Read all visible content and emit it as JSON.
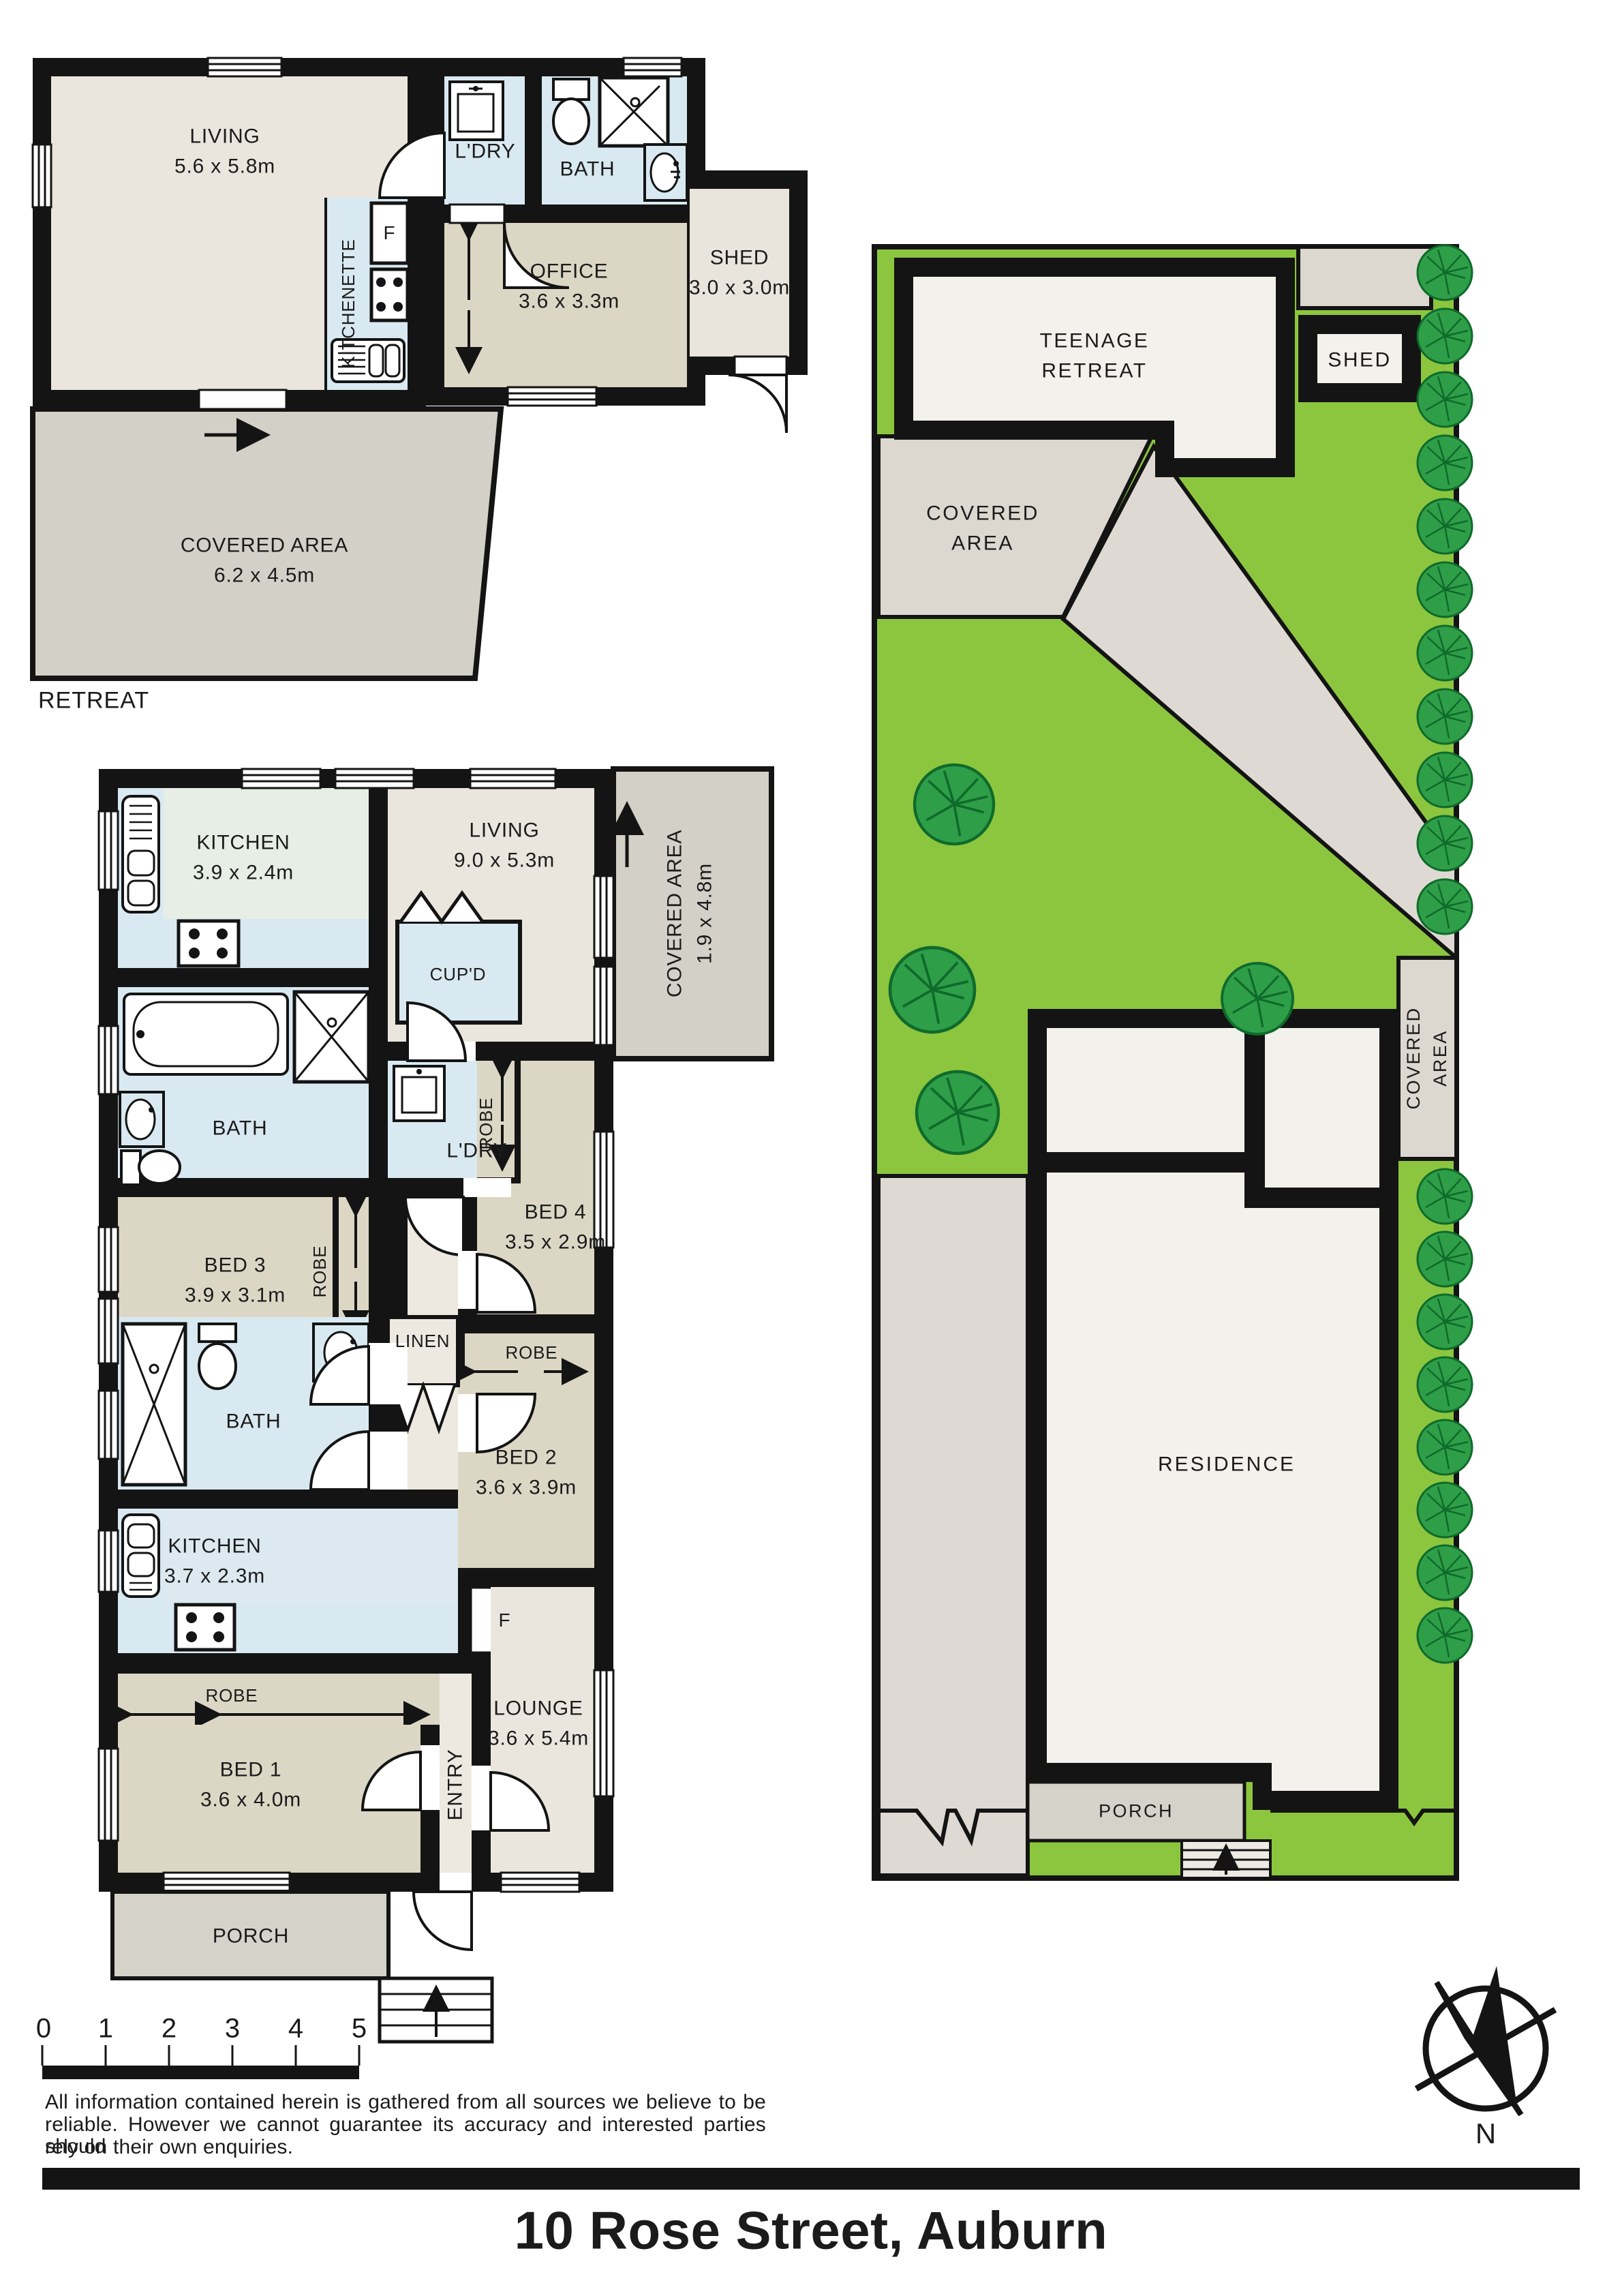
{
  "title": "10 Rose Street, Auburn",
  "colors": {
    "wall": "#141414",
    "floor_beige": "#EAE6DE",
    "floor_khaki": "#DCD7C5",
    "floor_wet_blue": "#D9E9F1",
    "floor_mint": "#E7EEE6",
    "covered_gray": "#D3D0C7",
    "porch_gray": "#D5D2C9",
    "site_paving": "#DEDAD3",
    "site_beige": "#DCD8CF",
    "lawn_green": "#8CC63E",
    "tree_green": "#2F9E48",
    "building_white": "#F2F1EC"
  },
  "scale_bar": {
    "t0": "0",
    "t1": "1",
    "t2": "2",
    "t3": "3",
    "t4": "4",
    "t5": "5"
  },
  "disclaimer": {
    "line1": "All information contained herein is gathered from all sources we believe to be",
    "line2": "reliable. However we cannot guarantee its accuracy and interested parties should",
    "line3": "rely on their own enquiries."
  },
  "compass": {
    "north_label": "N"
  },
  "retreat_plan": {
    "caption": "RETREAT",
    "living": {
      "name": "LIVING",
      "dims": "5.6 x 5.8m"
    },
    "kitchenette": {
      "name": "KITCHENETTE"
    },
    "fridge": {
      "label": "F"
    },
    "laundry": {
      "name": "L'DRY"
    },
    "bath": {
      "name": "BATH"
    },
    "office": {
      "name": "OFFICE",
      "dims": "3.6 x 3.3m"
    },
    "shed": {
      "name": "SHED",
      "dims": "3.0 x 3.0m"
    },
    "covered_area": {
      "name": "COVERED AREA",
      "dims": "6.2 x 4.5m"
    }
  },
  "main_plan": {
    "kitchen": {
      "name": "KITCHEN",
      "dims": "3.9 x 2.4m"
    },
    "cupboard": {
      "name": "CUP'D"
    },
    "living": {
      "name": "LIVING",
      "dims": "9.0 x 5.3m"
    },
    "covered_area": {
      "name": "COVERED AREA",
      "dims": "1.9 x 4.8m"
    },
    "bath": {
      "name": "BATH"
    },
    "laundry": {
      "name": "L'DRY"
    },
    "bed3": {
      "name": "BED 3",
      "dims": "3.9 x 3.1m"
    },
    "robe3": {
      "name": "ROBE"
    },
    "bed4": {
      "name": "BED 4",
      "dims": "3.5 x 2.9m"
    },
    "robe4": {
      "name": "ROBE"
    },
    "linen": {
      "name": "LINEN"
    },
    "bath2": {
      "name": "BATH"
    },
    "robe2": {
      "name": "ROBE"
    },
    "bed2": {
      "name": "BED 2",
      "dims": "3.6 x 3.9m"
    },
    "kitchen2": {
      "name": "KITCHEN",
      "dims": "3.7 x 2.3m"
    },
    "fridge": {
      "label": "F"
    },
    "robe1": {
      "name": "ROBE"
    },
    "bed1": {
      "name": "BED 1",
      "dims": "3.6 x 4.0m"
    },
    "entry": {
      "name": "ENTRY"
    },
    "lounge": {
      "name": "LOUNGE",
      "dims": "3.6 x 5.4m"
    },
    "porch": {
      "name": "PORCH"
    }
  },
  "site_plan": {
    "teenage_retreat": {
      "line1": "TEENAGE",
      "line2": "RETREAT"
    },
    "shed": {
      "name": "SHED"
    },
    "covered_area_rear": {
      "line1": "COVERED",
      "line2": "AREA"
    },
    "covered_area_side": {
      "line1": "COVERED",
      "line2": "AREA"
    },
    "residence": {
      "name": "RESIDENCE"
    },
    "porch": {
      "name": "PORCH"
    }
  }
}
